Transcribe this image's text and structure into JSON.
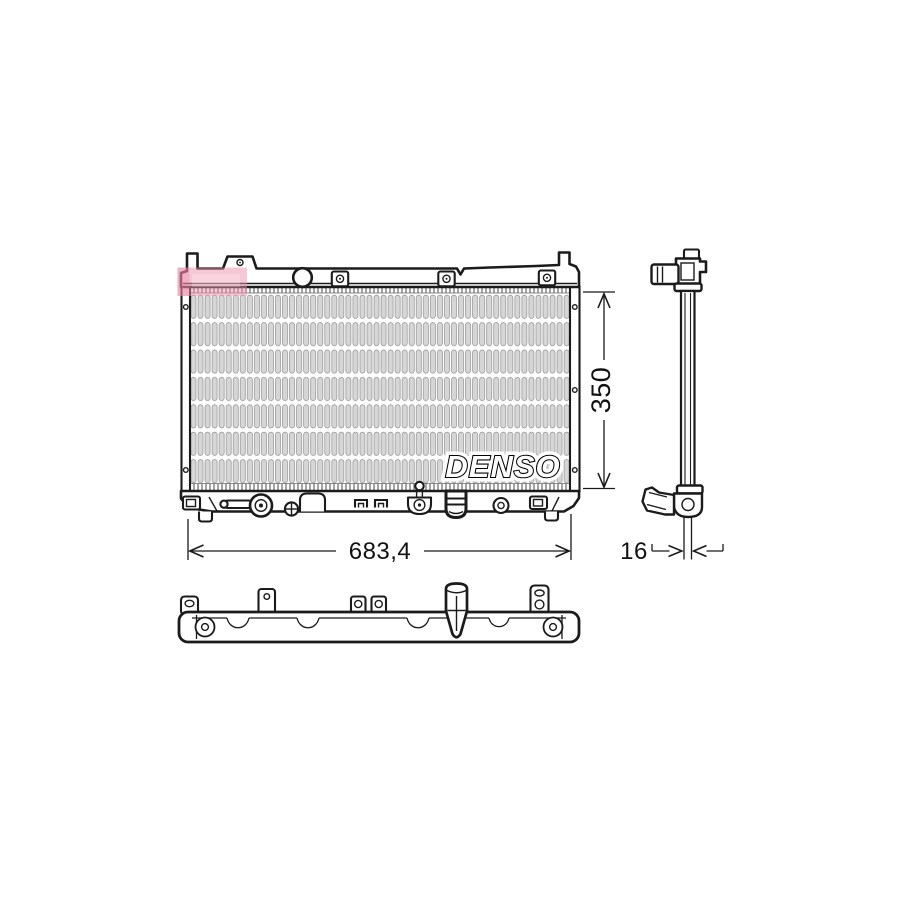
{
  "drawing": {
    "brand_logo": "DENSO",
    "highlight_color": "#ee92ab",
    "line_color": "#1b1b1b",
    "core_fill": "#d6d6d6"
  },
  "dimensions": {
    "overall_width": {
      "label": "683,4"
    },
    "core_height": {
      "label": "350"
    },
    "core_depth": {
      "label": "16"
    }
  }
}
